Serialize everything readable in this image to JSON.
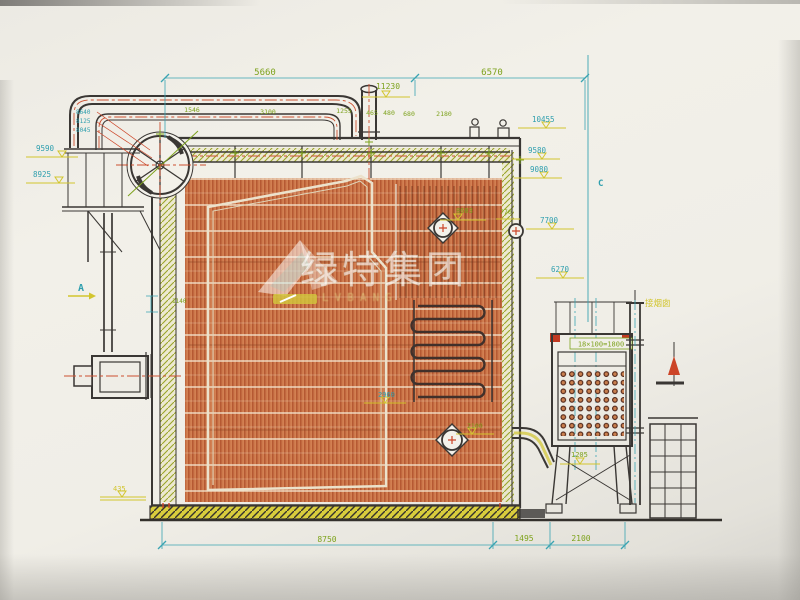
{
  "dimensions": {
    "top": {
      "overall_left": "5660",
      "overall_right": "6570",
      "level": "11230"
    },
    "top_row": [
      "1546",
      "3100",
      "1255",
      "465",
      "480",
      "680",
      "2180"
    ],
    "bottom": {
      "d1": "8750",
      "d2": "1495",
      "d3": "2100"
    }
  },
  "elevations": {
    "left": {
      "a": "8640",
      "b": "8125",
      "c": "8045",
      "d": "9590",
      "e": "8925"
    },
    "right": {
      "a": "10455",
      "b": "9580",
      "c": "9080",
      "d": "7700",
      "e": "6270"
    }
  },
  "interior": {
    "a": "8603",
    "b": "770",
    "c": "2960",
    "d": "2100",
    "e": "1205",
    "f": "435",
    "g": "1140"
  },
  "economizer": {
    "label": "18×100=1800"
  },
  "markers": {
    "section_a": "A",
    "section_c": "C"
  },
  "notes": {
    "to_chimney": "接烟囱"
  },
  "watermark": {
    "text": "绿特集团",
    "subtext": "LVBANG"
  },
  "colors": {
    "paper": "#f0eee7",
    "line_dark": "#3a3734",
    "tube_orange": "#d6895a",
    "hatch_orange": "#a63f1d",
    "dim_teal": "#3aa4b2",
    "dim_green": "#7da21c",
    "level_yellow": "#d2c52e",
    "mark_red": "#cc4427",
    "watermark_white": "#ffffff"
  }
}
